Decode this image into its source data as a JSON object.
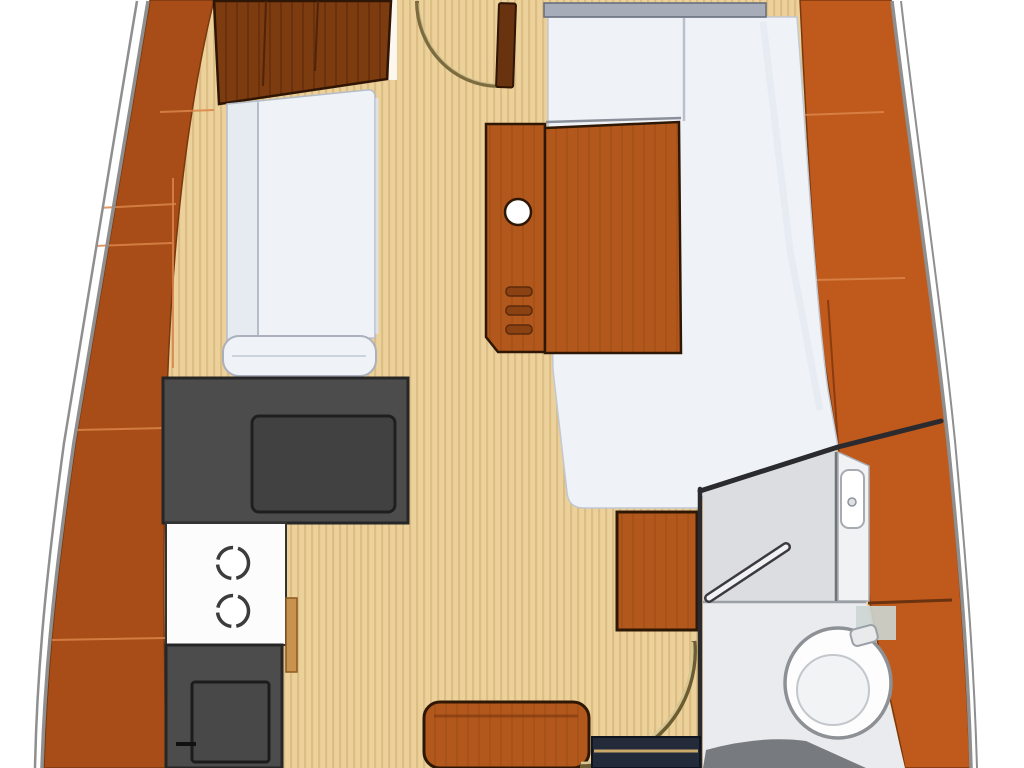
{
  "image": {
    "width": 1024,
    "height": 768,
    "kind": "boat-interior-floorplan"
  },
  "colors": {
    "page-bg": "#ffffff",
    "hull-line": "#8f8f8f",
    "wood-hull-left": "#a84d18",
    "wood-hull-right": "#c05a1c",
    "wood-seam-light": "#d9854a",
    "cabinet-wood": "#7d3b10",
    "door-wood": "#6a3310",
    "outline-dark": "#2e1805",
    "floor-tan": "#ecd19b",
    "floor-stripe": "#dcbd84",
    "cushion-white": "#eff3f8",
    "cushion-shade": "#e6ebf2",
    "cushion-line": "#b6bdc9",
    "berth-top-band": "#a7adb8",
    "counter-grey": "#4c4c4c",
    "counter-outline": "#262626",
    "sink-grey": "#414141",
    "stove-white": "#fcfcfc",
    "burner-ring": "#3c3c3c",
    "table-wood": "#b2581c",
    "table-grain": "#9d4c15",
    "block-wood": "#b4561d",
    "head-wall": "#2b2b2f",
    "head-floor": "#dcdde0",
    "head-floor-light": "#eaebee",
    "head-line": "#9aa0a6",
    "toilet-white": "#fdfdfd",
    "toilet-rim": "#8d9196",
    "steps-navy": "#232a3a",
    "steps-stripe": "#c9a869",
    "arc-olive": "#7b6b3e",
    "floor-arc-tan": "#d7c592"
  }
}
